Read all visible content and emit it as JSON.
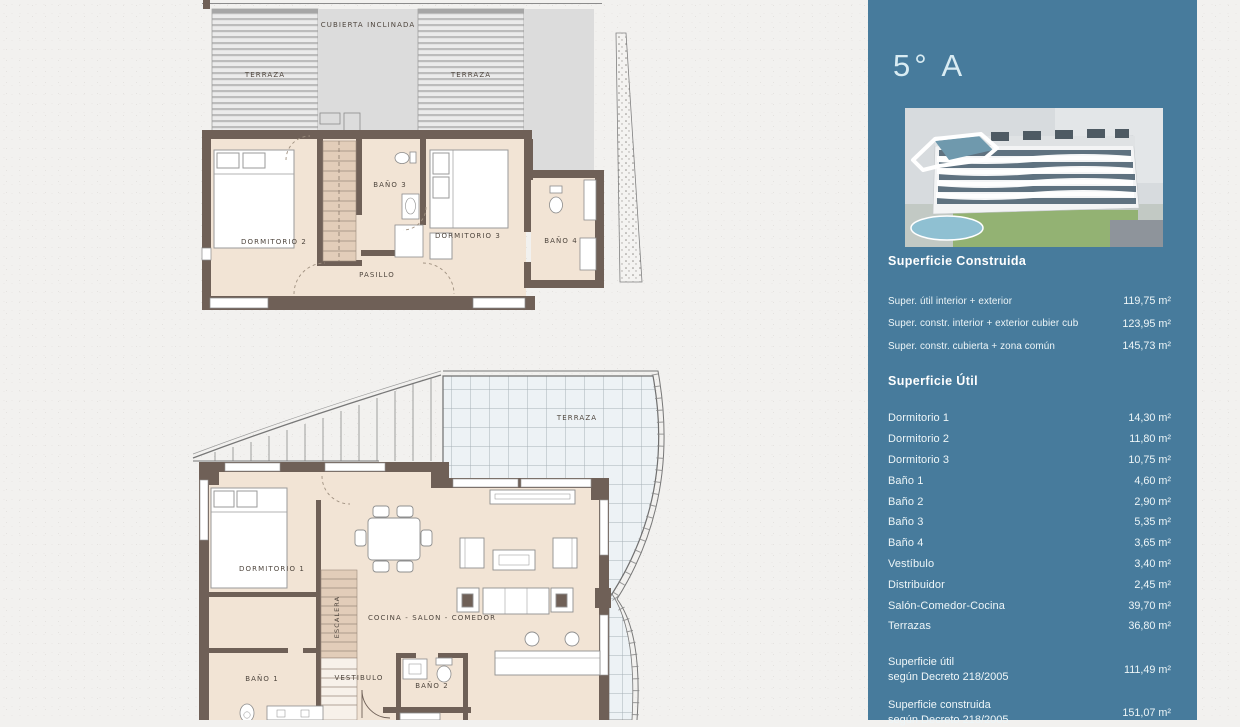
{
  "colors": {
    "panel_teal": "#477b9c",
    "wall": "#6f6057",
    "floor": "#f2e4d5",
    "paper": "#f2f1ef"
  },
  "sidebar": {
    "title": "5° A",
    "construida": {
      "heading": "Superficie Construida",
      "rows": [
        {
          "label": "Super. útil interior + exterior",
          "value": "119,75 m²"
        },
        {
          "label": "Super. constr. interior + exterior cubier cub",
          "value": "123,95 m²"
        },
        {
          "label": "Super. constr. cubierta + zona común",
          "value": "145,73 m²"
        }
      ]
    },
    "util": {
      "heading": "Superficie Útil",
      "rows": [
        {
          "label": "Dormitorio 1",
          "value": "14,30 m²"
        },
        {
          "label": "Dormitorio 2",
          "value": "11,80 m²"
        },
        {
          "label": "Dormitorio 3",
          "value": "10,75 m²"
        },
        {
          "label": "Baño 1",
          "value": "4,60 m²"
        },
        {
          "label": "Baño 2",
          "value": "2,90 m²"
        },
        {
          "label": "Baño 3",
          "value": "5,35 m²"
        },
        {
          "label": "Baño 4",
          "value": "3,65 m²"
        },
        {
          "label": "Vestíbulo",
          "value": "3,40 m²"
        },
        {
          "label": "Distribuidor",
          "value": "2,45 m²"
        },
        {
          "label": "Salón-Comedor-Cocina",
          "value": "39,70 m²"
        },
        {
          "label": "Terrazas",
          "value": "36,80 m²"
        }
      ]
    },
    "summary": [
      {
        "line1": "Superficie útil",
        "line2": "según Decreto 218/2005",
        "value": "111,49 m²"
      },
      {
        "line1": "Superficie construida",
        "line2": "según Decreto 218/2005",
        "value": "151,07 m²"
      }
    ]
  },
  "plan_top": {
    "labels": {
      "cubierta": "CUBIERTA INCLINADA",
      "terraza_left": "TERRAZA",
      "terraza_right": "TERRAZA",
      "dormitorio2": "DORMITORIO 2",
      "bano3": "BAÑO 3",
      "dormitorio3": "DORMITORIO 3",
      "bano4": "BAÑO 4",
      "pasillo": "PASILLO"
    }
  },
  "plan_bottom": {
    "labels": {
      "terraza": "TERRAZA",
      "dormitorio1": "DORMITORIO 1",
      "escalera": "ESCALERA",
      "cocina": "COCINA - SALON - COMEDOR",
      "bano1": "BAÑO 1",
      "vestibulo": "VESTIBULO",
      "bano2": "BAÑO 2"
    }
  }
}
